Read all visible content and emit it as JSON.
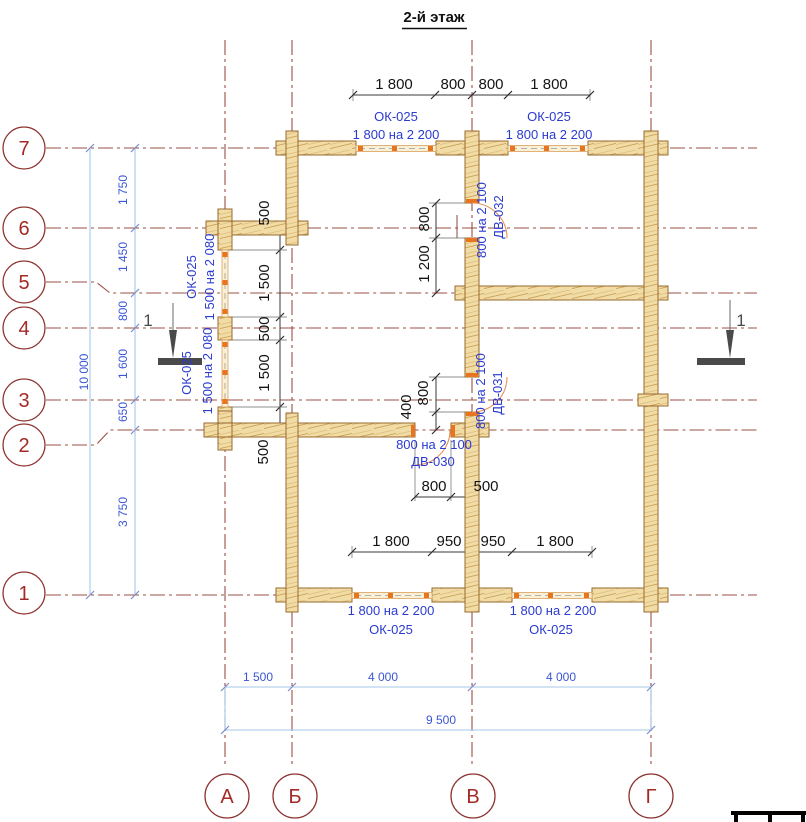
{
  "title": "2-й этаж",
  "colors": {
    "axis_maroon": "#9b4f45",
    "axis_label_red": "#a32a26",
    "dim_blue_text": "#2a3bd0",
    "dim_blue_line": "#a6c8e8",
    "dim_black": "#141414",
    "wall_fill": "#f1dca6",
    "wall_stroke": "#9a6a2e",
    "opening_orange": "#e8741f",
    "section_gray": "#4a4a4a"
  },
  "axis_rows": [
    "7",
    "6",
    "5",
    "4",
    "3",
    "2",
    "1"
  ],
  "axis_cols": [
    "А",
    "Б",
    "В",
    "Г"
  ],
  "dims": {
    "top": [
      "1 800",
      "800",
      "800",
      "1 800"
    ],
    "left_outer": [
      "1 750",
      "1 450",
      "800",
      "1 600",
      "650",
      "3 750"
    ],
    "left_total": "10 000",
    "wall_a_chain": [
      "500",
      "1 500",
      "500",
      "1 500",
      "500"
    ],
    "axis_v_upper": [
      "800",
      "1 200"
    ],
    "axis_v_mid": [
      "800",
      "400"
    ],
    "door_bottom": [
      "800",
      "500"
    ],
    "bottom_inner": [
      "1 800",
      "950",
      "950",
      "1 800"
    ],
    "bottom_spans": [
      "1 500",
      "4 000",
      "4 000"
    ],
    "bottom_total": "9 500"
  },
  "openings": {
    "top_left_window": {
      "code": "ОК-025",
      "size": "1 800 на 2 200"
    },
    "top_right_window": {
      "code": "ОК-025",
      "size": "1 800 на 2 200"
    },
    "left_upper_window": {
      "code": "ОК-025",
      "size": "1 500 на 2 080"
    },
    "left_lower_window": {
      "code": "ОК-025",
      "size": "1 500 на 2 080"
    },
    "bottom_left_window": {
      "code": "ОК-025",
      "size": "1 800 на 2 200"
    },
    "bottom_right_window": {
      "code": "ОК-025",
      "size": "1 800 на 2 200"
    },
    "door_032": {
      "code": "ДВ-032",
      "size": "800 на 2 100"
    },
    "door_031": {
      "code": "ДВ-031",
      "size": "800 на 2 100"
    },
    "door_030": {
      "code": "ДВ-030",
      "size": "800 на 2 100"
    }
  },
  "section_marks": {
    "left": "1",
    "right": "1"
  }
}
